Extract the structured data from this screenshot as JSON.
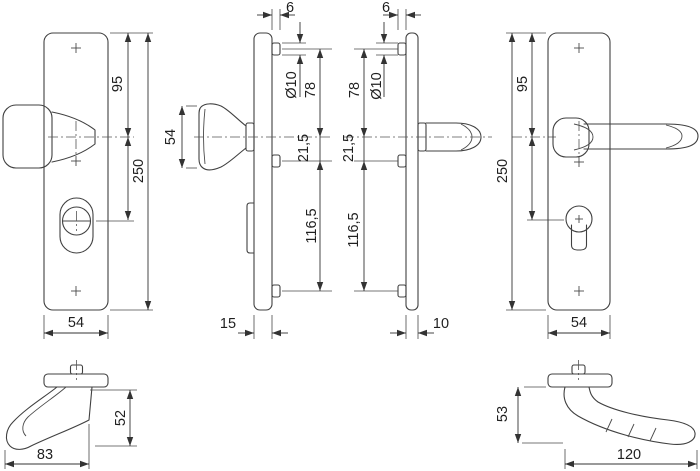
{
  "dimensions": {
    "front_knob_plate": {
      "top_to_handle_axis": "95",
      "total_height": "250",
      "width": "54"
    },
    "side_knob_plate": {
      "fixing_boss_depth": "6",
      "knob_height": "54",
      "fixing_hole_diameter": "Ø10",
      "top_fixing_to_handle_axis": "78",
      "handle_axis_to_fixing": "21,5",
      "fixing_spacing": "116,5",
      "plate_depth": "15"
    },
    "side_lever_plate": {
      "fixing_boss_depth": "6",
      "fixing_hole_diameter": "Ø10",
      "top_fixing_to_handle_axis": "78",
      "handle_axis_to_fixing": "21,5",
      "fixing_spacing": "116,5",
      "plate_depth": "10"
    },
    "front_lever_plate": {
      "top_to_handle_axis": "95",
      "total_height": "250",
      "width": "54"
    },
    "knob_side_profile": {
      "projection": "52",
      "length": "83"
    },
    "lever_side_profile": {
      "projection": "53",
      "length": "120"
    }
  }
}
